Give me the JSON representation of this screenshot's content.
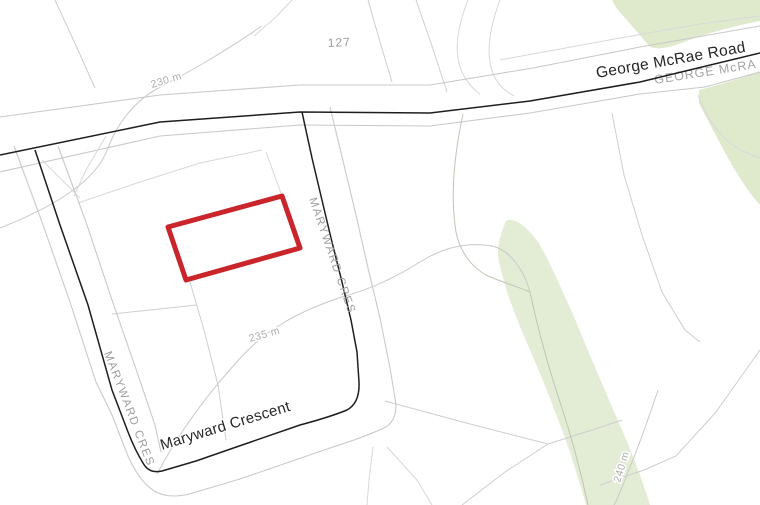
{
  "map": {
    "kind": "cadastral-parcel-map",
    "labels": {
      "parcel_number": "127",
      "road_main": "George McRae Road",
      "road_main_caps_gray": "GEORGE McRA",
      "road_cres_right": "MARYWARD CRES",
      "road_cres_left": "MARYWARD CRES",
      "road_cres_bottom": "Maryward Crescent",
      "contour_230": "230 m",
      "contour_235": "235 m",
      "contour_240": "240 m"
    },
    "colors": {
      "background": "#ffffff",
      "parcel_line": "#cecece",
      "contour_line": "#c9c9c9",
      "road_casing": "#1e1e1e",
      "road_label_black": "#262626",
      "road_label_gray": "#9e9e9e",
      "contour_label_gray": "#ababab",
      "highlight_outline": "#c9252b",
      "vegetation": "#dfe9cc",
      "vegetation_band": "#e3ecd4"
    }
  }
}
